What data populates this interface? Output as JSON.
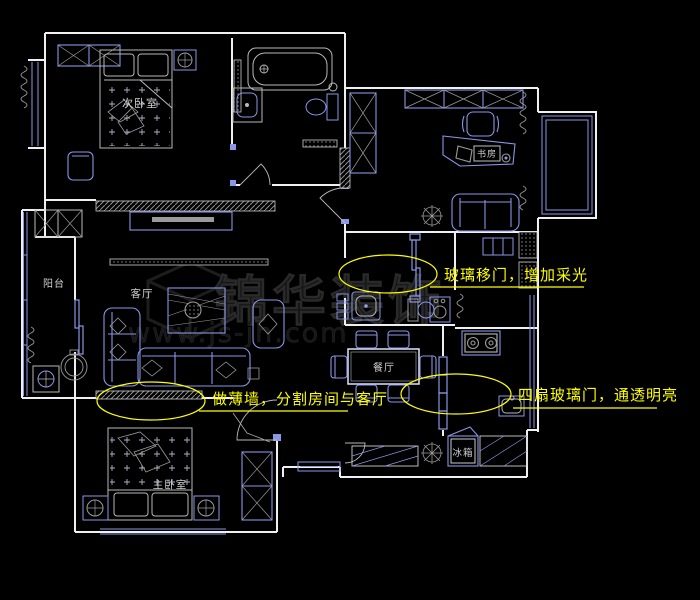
{
  "drawing": {
    "type": "cad-floor-plan",
    "canvas": {
      "width": 700,
      "height": 600,
      "background": "#000000"
    },
    "palette": {
      "wall": "#f0f0f0",
      "fixture_blue": "#8a96e6",
      "detail_gray": "#a0a0a0",
      "annotation_yellow": "#ffff00",
      "hatch_gray": "#8f8f8f",
      "watermark_gray": "#1f1f1f"
    },
    "room_labels": {
      "secondary_bedroom": "次卧室",
      "study": "书房",
      "balcony": "阳台",
      "living_room": "客厅",
      "dining_room": "餐厅",
      "master_bedroom": "主卧室",
      "fridge": "冰箱"
    },
    "annotations": {
      "glass_sliding_door": "玻璃移门，增加采光",
      "thin_wall": "做薄墙，分割房间与客厅",
      "four_glass_doors": "四扇玻璃门，通透明亮"
    },
    "watermark": {
      "brand": "锦华装饰",
      "url": "www.js-jh.com"
    }
  }
}
